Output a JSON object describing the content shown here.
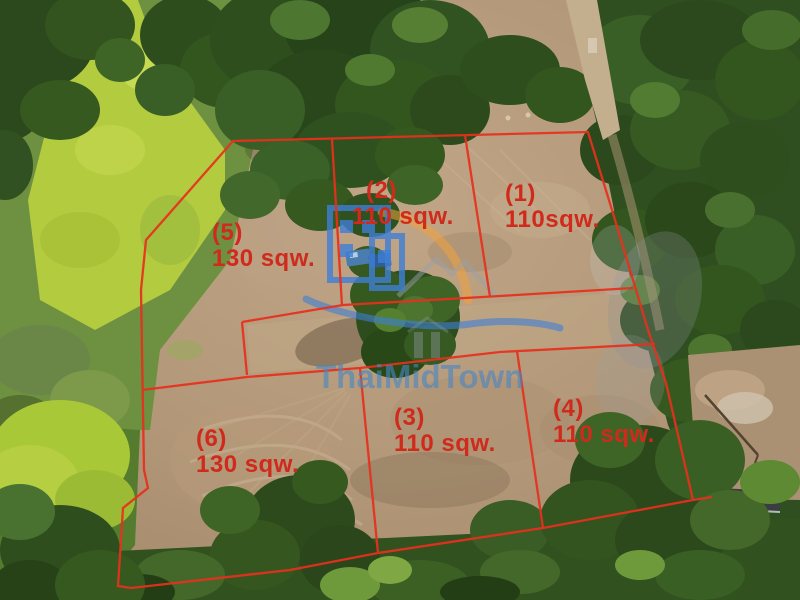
{
  "scene": {
    "description": "Aerial drone photo of cleared land subdivided into six numbered plots outlined in red",
    "colors": {
      "boundary_red": "#e7301d",
      "label_red": "#cf2a1c",
      "watermark_blue": "#3f7fd6",
      "watermark_orange": "#f0a23c"
    }
  },
  "watermark": {
    "brand": "ThaiMidTown"
  },
  "plots": [
    {
      "number": "(1)",
      "area": "110sqw."
    },
    {
      "number": "(2)",
      "area": "110 sqw."
    },
    {
      "number": "(3)",
      "area": "110 sqw."
    },
    {
      "number": "(4)",
      "area": "110 sqw."
    },
    {
      "number": "(5)",
      "area": "130 sqw."
    },
    {
      "number": "(6)",
      "area": "130 sqw."
    }
  ]
}
